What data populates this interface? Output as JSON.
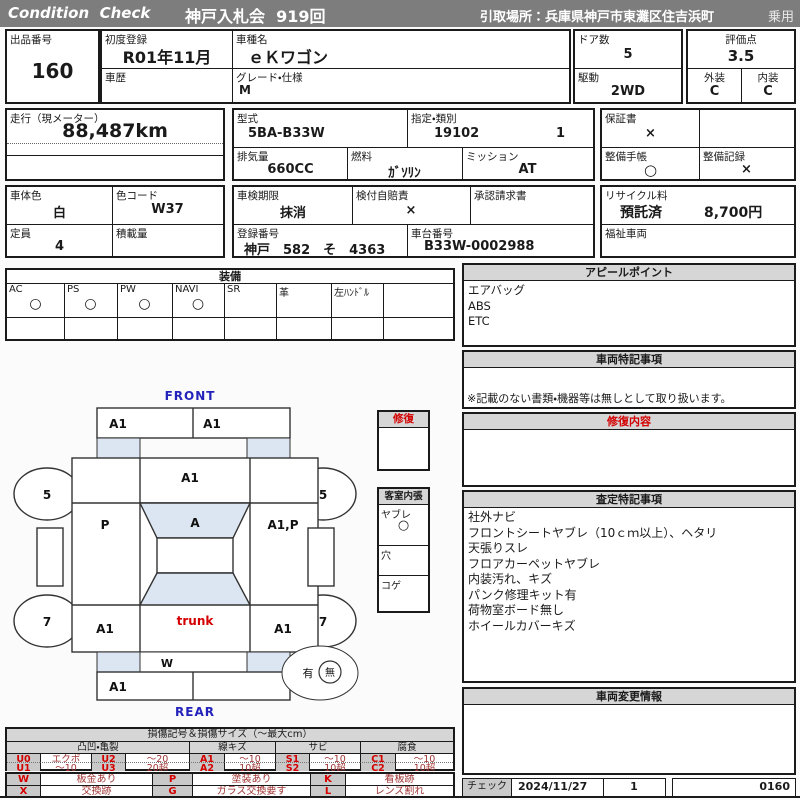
{
  "header": {
    "brand": "Condition  Check",
    "auction": "神戸入札会  919回",
    "pickup": "引取場所：兵庫県神戸市東灘区住吉浜町",
    "vehicle_class": "乗用"
  },
  "f": {
    "lot_l": "出品番号",
    "lot_v": "160",
    "firstreg_l": "初度登録",
    "firstreg_v": "R01年11月",
    "history_l": "車歴",
    "model_l": "車種名",
    "model_v": "ｅＫワゴン",
    "grade_l": "グレード・仕様",
    "grade_v": "M",
    "doors_l": "ドア数",
    "doors_v": "5",
    "drive_l": "駆動",
    "drive_v": "2WD",
    "score_l": "評価点",
    "score_v": "3.5",
    "ext_l": "外装",
    "ext_v": "C",
    "int_l": "内装",
    "int_v": "C",
    "mileage_l": "走行（現メーター）",
    "mileage_v": "88,487km",
    "type_l": "型式",
    "type_v": "5BA-B33W",
    "class_l": "指定・類別",
    "class_v1": "19102",
    "class_v2": "1",
    "disp_l": "排気量",
    "disp_v": "660CC",
    "fuel_l": "燃料",
    "fuel_v": "ｶﾞｿﾘﾝ",
    "mission_l": "ミッション",
    "mission_v": "AT",
    "warranty_l": "保証書",
    "warranty_v": "×",
    "book_l": "整備手帳",
    "book_v": "○",
    "record_l": "整備記録",
    "record_v": "×",
    "bodycolor_l": "車体色",
    "bodycolor_v": "白",
    "colorcode_l": "色コード",
    "colorcode_v": "W37",
    "inspect_l": "車検期限",
    "inspect_v": "抹消",
    "insurance_l": "検付自賠責",
    "insurance_v": "×",
    "approval_l": "承認請求書",
    "recycle_l": "リサイクル料",
    "recycle_s": "預託済",
    "recycle_fee": "8,700円",
    "capacity_l": "定員",
    "capacity_v": "4",
    "load_l": "積載量",
    "regno_l": "登録番号",
    "regno_v": "神戸　582　そ　4363",
    "chassis_l": "車台番号",
    "chassis_v": "B33W-0002988",
    "welfare_l": "福祉車両"
  },
  "equipment": {
    "title": "装備",
    "items": [
      {
        "label": "AC",
        "mark": "○"
      },
      {
        "label": "PS",
        "mark": "○"
      },
      {
        "label": "PW",
        "mark": "○"
      },
      {
        "label": "NAVI",
        "mark": "○"
      },
      {
        "label": "SR",
        "mark": ""
      },
      {
        "label": "革",
        "mark": ""
      },
      {
        "label": "左ﾊﾝﾄﾞﾙ",
        "mark": ""
      },
      {
        "label": "",
        "mark": ""
      }
    ]
  },
  "appeal": {
    "title": "アピールポイント",
    "lines": [
      "エアバッグ",
      "ABS",
      "ETC"
    ]
  },
  "notes": {
    "title": "車両特記事項",
    "foot": "※記載のない書類・機器等は無しとして取り扱います。"
  },
  "repair": {
    "title": "修復内容"
  },
  "assess": {
    "title": "査定特記事項",
    "lines": [
      "社外ナビ",
      "フロントシートヤブレ（10ｃｍ以上）、ヘタリ",
      "天張りスレ",
      "フロアカーペットヤブレ",
      "内装汚れ、キズ",
      "パンク修理キット有",
      "荷物室ボード無し",
      "ホイールカバーキズ"
    ]
  },
  "change": {
    "title": "車両変更情報"
  },
  "check": {
    "label": "チェック",
    "date": "2024/11/27",
    "count": "1",
    "code": "0160"
  },
  "repbox": {
    "title": "修復"
  },
  "cabin": {
    "title": "客室内張",
    "rows": [
      {
        "label": "ヤブレ",
        "mark": "○"
      },
      {
        "label": "穴",
        "mark": ""
      },
      {
        "label": "コゲ",
        "mark": ""
      }
    ]
  },
  "diag": {
    "front": "FRONT",
    "rear": "REAR",
    "marks": {
      "front_bumper_left": "A1",
      "front_bumper_right": "A1",
      "hood": "A1",
      "windshield": "A",
      "left_front_door": "P",
      "right_front_door": "A1,P",
      "left_rear_quarter": "A1",
      "right_rear_quarter": "A1",
      "trunk": "trunk",
      "rear_panel": "W",
      "rear_bumper_left": "A1",
      "front_wheel_left": "5",
      "front_wheel_right": "5",
      "rear_wheel_left": "7",
      "rear_wheel_right": "7",
      "spare_presence": "有",
      "spare_absence": "無"
    }
  },
  "legend": {
    "title": "損傷記号＆損傷サイズ（～最大cm）",
    "groups": [
      "凸凹・亀裂",
      "線キズ",
      "サビ",
      "腐食"
    ],
    "rows": [
      [
        "U0",
        "エクボ",
        "U2",
        "～20",
        "A1",
        "～10",
        "S1",
        "～10",
        "C1",
        "～10"
      ],
      [
        "U1",
        "～10",
        "U3",
        "20超",
        "A2",
        "10超",
        "S2",
        "10超",
        "C2",
        "10超"
      ]
    ],
    "sym": [
      [
        "W",
        "板金あり",
        "P",
        "塗装あり",
        "K",
        "看板跡"
      ],
      [
        "X",
        "交換跡",
        "G",
        "ガラス交換要す",
        "L",
        "レンズ割れ"
      ]
    ]
  },
  "colors": {
    "header_bg": "#7d7d7d",
    "section_bg": "#d6d6d6",
    "accent_red": "#d40000",
    "accent_blue": "#2323bb",
    "glass_fill": "#dce6f2",
    "legend_code_bg": "#c9c9c9"
  }
}
